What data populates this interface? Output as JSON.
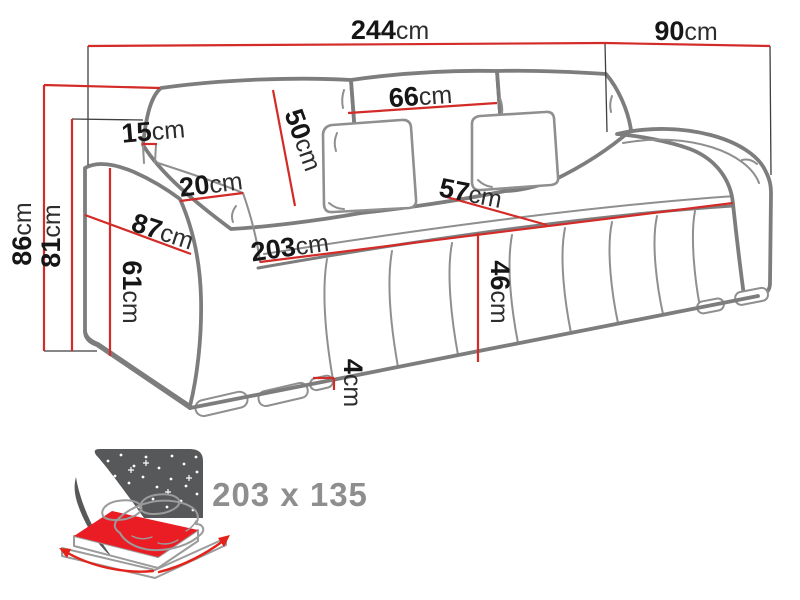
{
  "diagram_title": "sofa-dimension-diagram",
  "colors": {
    "dimension_line": "#d32b28",
    "sofa_outline": "#7d7d7d",
    "label_number": "#161616",
    "label_unit": "#2d2d2d",
    "sleeping_label": "#8e8e8e",
    "icon_night_sky": "#57585a",
    "icon_mattress_red": "#ea1c24"
  },
  "dims": {
    "total_width": {
      "num": "244",
      "unit": "cm"
    },
    "total_depth": {
      "num": "90",
      "unit": "cm"
    },
    "total_height": {
      "num": "86",
      "unit": "cm"
    },
    "back_height": {
      "num": "81",
      "unit": "cm"
    },
    "back_post": {
      "num": "15",
      "unit": "cm"
    },
    "cushion_height": {
      "num": "50",
      "unit": "cm"
    },
    "cushion_width": {
      "num": "66",
      "unit": "cm"
    },
    "armrest_top_width": {
      "num": "20",
      "unit": "cm"
    },
    "armrest_depth": {
      "num": "87",
      "unit": "cm"
    },
    "seat_depth": {
      "num": "57",
      "unit": "cm"
    },
    "seat_width": {
      "num": "203",
      "unit": "cm"
    },
    "seat_height": {
      "num": "46",
      "unit": "cm"
    },
    "armrest_height": {
      "num": "61",
      "unit": "cm"
    },
    "leg_height": {
      "num": "4",
      "unit": "cm"
    }
  },
  "sleeping_area": {
    "label": "203 x 135",
    "icon": "bed-night-icon"
  }
}
